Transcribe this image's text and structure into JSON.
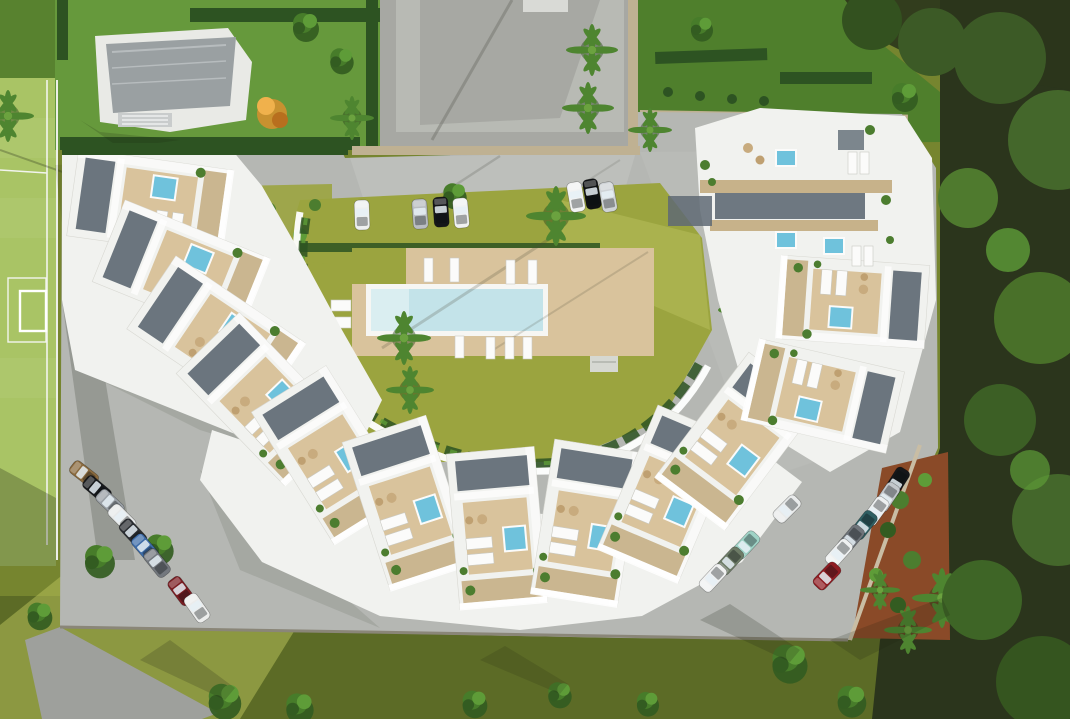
{
  "scene": {
    "title": "aerial-3d-render-residential-complex",
    "description": "Top-down architectural 3D rendering of a crescent-shaped white apartment complex with rooftop terraces and hot tubs around a central courtyard with a rectangular swimming pool, surrounded by parking rows, a sports field, neighbouring villas and woodland",
    "elements": [
      "sports-field",
      "neighbor-villa",
      "neighbor-paved-plot",
      "neighbor-garden",
      "central-swimming-pool",
      "pool-deck",
      "courtyard-lawn",
      "crescent-apartment-buildings",
      "rooftop-hot-tubs",
      "sun-loungers",
      "parking-rows",
      "palm-trees",
      "woodland",
      "garden-mulch-bed"
    ]
  },
  "palette": {
    "pavement": "#b5b7b3",
    "pavement_light": "#c6c8c3",
    "pavement_shade": "#9ea09c",
    "plot_paved": "#a7a8a3",
    "driveway_dark": "#6a7078",
    "lawn_outer": "#76852f",
    "lawn_dark": "#5c6b26",
    "lawn_courtyard": "#9ba43f",
    "lawn_courtyard_light": "#b4bd58",
    "field": "#a9c465",
    "neighbor_lawn": "#66993c",
    "neighbor_lawn_right": "#4f7f2c",
    "woodland": "#2b351c",
    "hedge": "#2d5322",
    "shrub": "#4c7d2f",
    "tree_mid": "#477c2a",
    "tree_light": "#5e9c38",
    "tree_deep": "#335c21",
    "palm_green": "#4e8530",
    "building": "#f1f2ef",
    "building_bright": "#ffffff",
    "roof_gray": "#9aa0a2",
    "deck": "#d9c39c",
    "pergola": "#c7b28a",
    "slat": "#5f6a74",
    "jacuzzi": "#6fc2dc",
    "pool_water": "#c3e3e9",
    "pool_shallow": "#daeef1",
    "pool_rim": "#f6f6f3",
    "wall_beige": "#bfb192",
    "mulch": "#8a4a28",
    "flower_pink": "#cf6d85",
    "flower_gold": "#d9a43a",
    "autumn": "#d98f2e"
  },
  "cars": {
    "left_row": [
      "#8a6a3e",
      "#17191c",
      "#9aa0a6",
      "#e8eaea",
      "#2a2d31",
      "#3e6ca8",
      "#73787e",
      "#7a1d22",
      "#ecedec"
    ],
    "top_row": [
      "#eef0f0",
      "#b9bdc1",
      "#141619",
      "#f0f2f2",
      "#f2f3f3",
      "#0f1113",
      "#cfd3d6"
    ],
    "right_row": [
      "#15171a",
      "#c3c7cb",
      "#edeff0",
      "#2f5f63",
      "#6f747a",
      "#eff1f1",
      "#8f1c22"
    ],
    "inner_row": [
      "#9fd3c6",
      "#6d7b66",
      "#f0f1f1",
      "#e9ebeb"
    ]
  }
}
